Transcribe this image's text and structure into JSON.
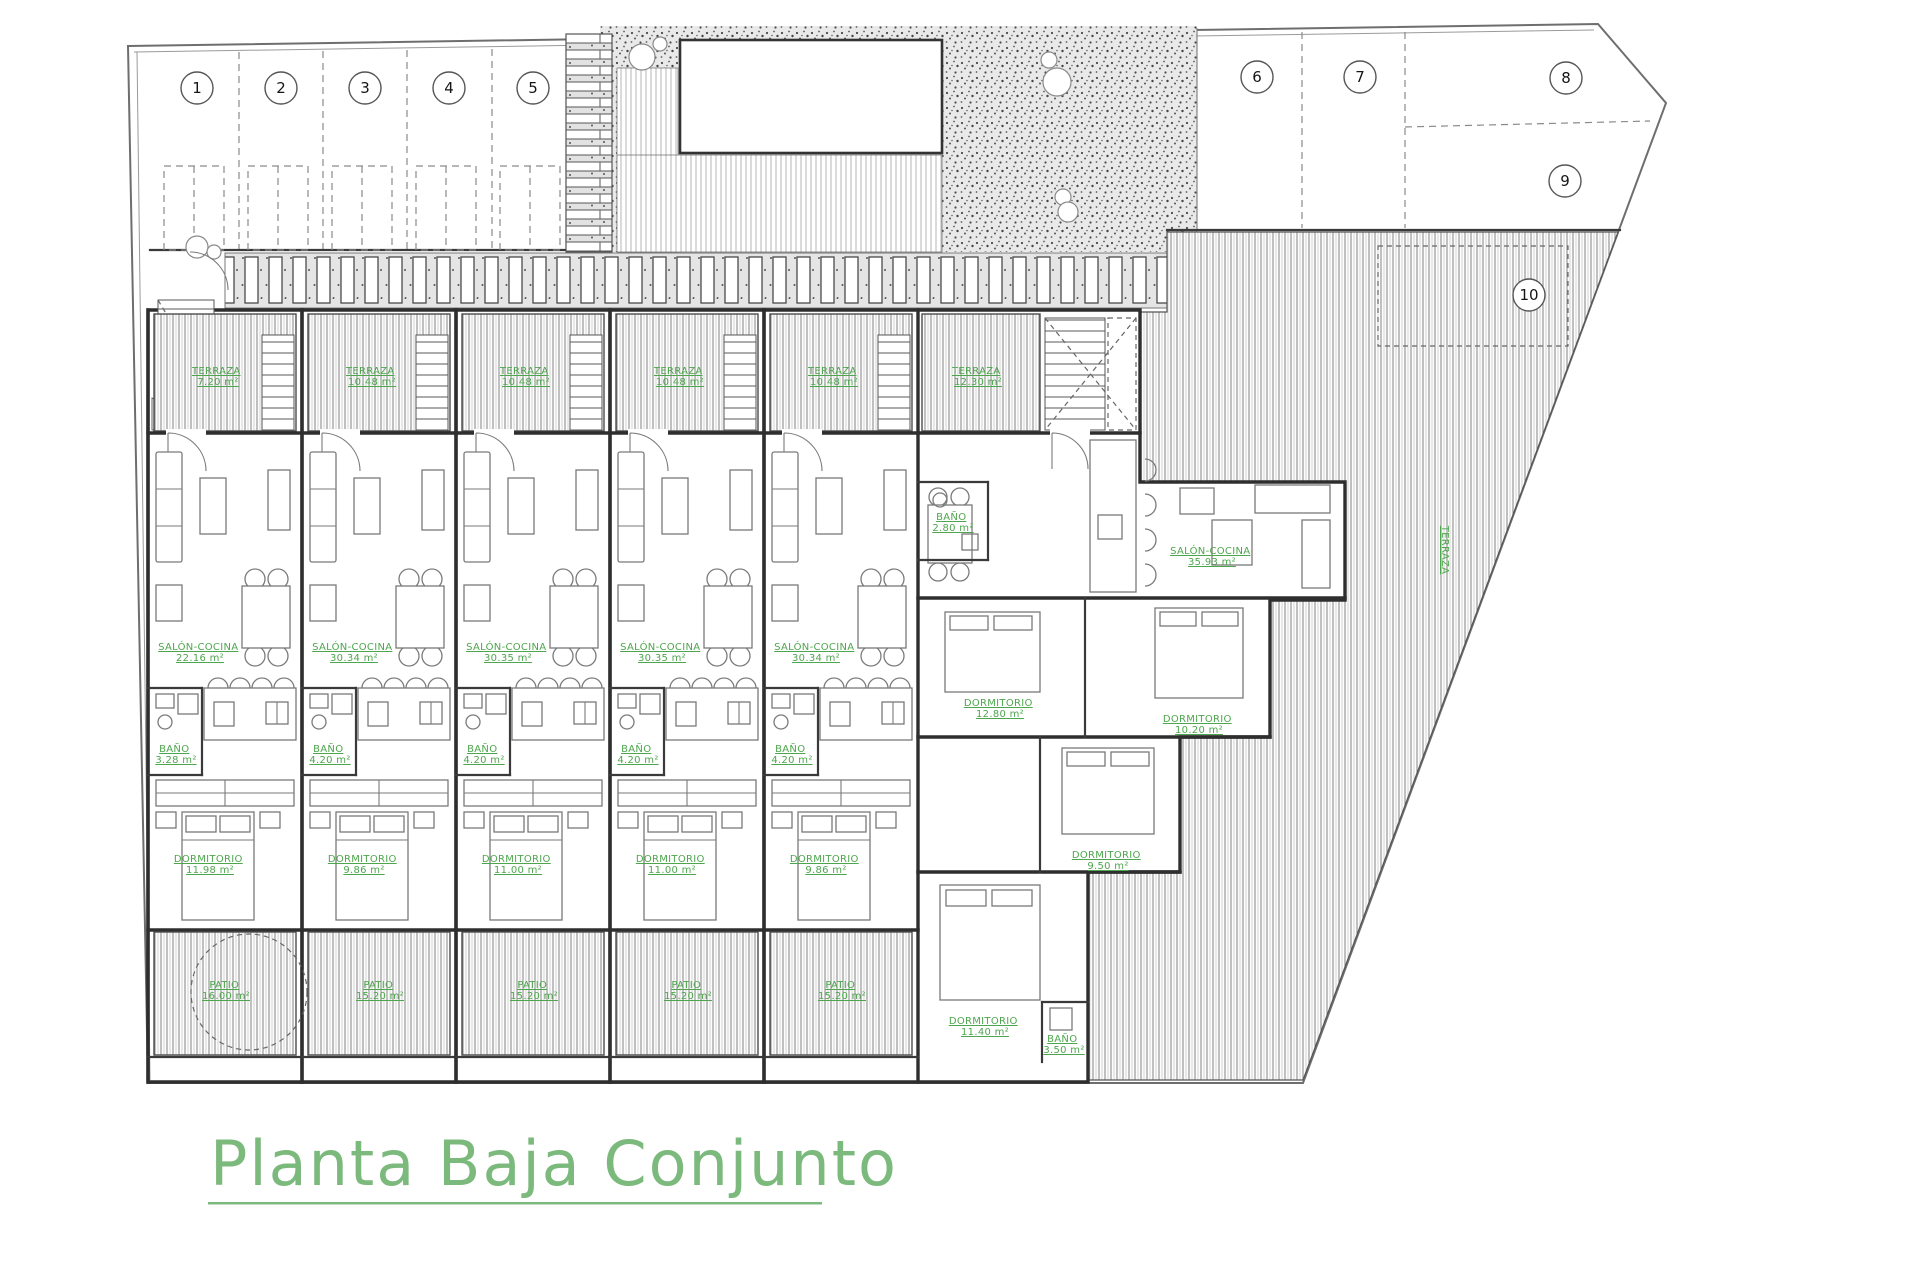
{
  "title": {
    "text": "Planta Baja Conjunto"
  },
  "colors": {
    "label_green": "#4da64d",
    "title_green": "#7cb97c",
    "wall": "#2e2e2e"
  },
  "parking": {
    "spots": [
      "1",
      "2",
      "3",
      "4",
      "5",
      "6",
      "7",
      "8",
      "9",
      "10"
    ]
  },
  "units": [
    {
      "terraza": {
        "name": "TERRAZA",
        "area": "7.20 m²"
      },
      "salon": {
        "name": "SALÓN-COCINA",
        "area": "22.16 m²"
      },
      "bano": {
        "name": "BAÑO",
        "area": "3.28 m²"
      },
      "dormitorio": {
        "name": "DORMITORIO",
        "area": "11.98 m²"
      },
      "patio": {
        "name": "PATIO",
        "area": "16.00 m²"
      }
    },
    {
      "terraza": {
        "name": "TERRAZA",
        "area": "10.48 m²"
      },
      "salon": {
        "name": "SALÓN-COCINA",
        "area": "30.34 m²"
      },
      "bano": {
        "name": "BAÑO",
        "area": "4.20 m²"
      },
      "dormitorio": {
        "name": "DORMITORIO",
        "area": "9.86 m²"
      },
      "patio": {
        "name": "PATIO",
        "area": "15.20 m²"
      }
    },
    {
      "terraza": {
        "name": "TERRAZA",
        "area": "10.48 m²"
      },
      "salon": {
        "name": "SALÓN-COCINA",
        "area": "30.35 m²"
      },
      "bano": {
        "name": "BAÑO",
        "area": "4.20 m²"
      },
      "dormitorio": {
        "name": "DORMITORIO",
        "area": "11.00 m²"
      },
      "patio": {
        "name": "PATIO",
        "area": "15.20 m²"
      }
    },
    {
      "terraza": {
        "name": "TERRAZA",
        "area": "10.48 m²"
      },
      "salon": {
        "name": "SALÓN-COCINA",
        "area": "30.35 m²"
      },
      "bano": {
        "name": "BAÑO",
        "area": "4.20 m²"
      },
      "dormitorio": {
        "name": "DORMITORIO",
        "area": "11.00 m²"
      },
      "patio": {
        "name": "PATIO",
        "area": "15.20 m²"
      }
    },
    {
      "terraza": {
        "name": "TERRAZA",
        "area": "10.48 m²"
      },
      "salon": {
        "name": "SALÓN-COCINA",
        "area": "30.34 m²"
      },
      "bano": {
        "name": "BAÑO",
        "area": "4.20 m²"
      },
      "dormitorio": {
        "name": "DORMITORIO",
        "area": "9.86 m²"
      },
      "patio": {
        "name": "PATIO",
        "area": "15.20 m²"
      }
    }
  ],
  "corner": {
    "terraza": {
      "name": "TERRAZA",
      "area": "12.30 m²"
    },
    "salon": {
      "name": "SALÓN-COCINA",
      "area": "35.93 m²"
    },
    "bano1": {
      "name": "BAÑO",
      "area": "2.80 m²"
    },
    "bano2": {
      "name": "BAÑO",
      "area": "3.50 m²"
    },
    "dorm1": {
      "name": "DORMITORIO",
      "area": "12.80 m²"
    },
    "dorm2": {
      "name": "DORMITORIO",
      "area": "10.20 m²"
    },
    "dorm3": {
      "name": "DORMITORIO",
      "area": "9.50 m²"
    },
    "dorm4": {
      "name": "DORMITORIO",
      "area": "11.40 m²"
    },
    "garden": {
      "name": "TERRAZA"
    }
  }
}
